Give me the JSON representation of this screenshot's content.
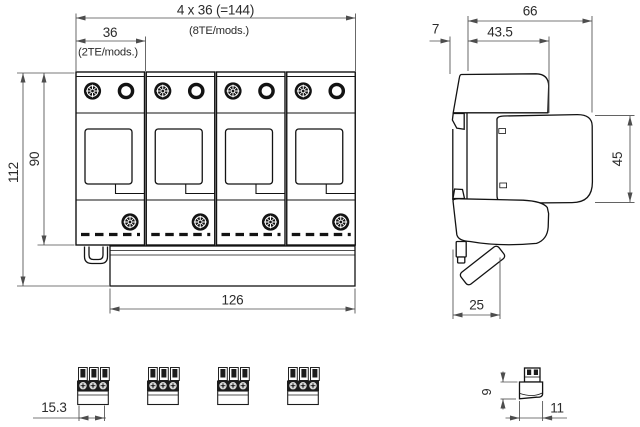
{
  "drawing": {
    "type": "technical-dimension-drawing",
    "units": "mm",
    "front_view": {
      "module_count": 4,
      "dims": {
        "total_width": "4 x 36 (=144)",
        "total_width_note": "(8TE/mods.)",
        "module_width": "36",
        "module_width_note": "(2TE/mods.)",
        "overall_height": "112",
        "body_height": "90",
        "rail_length": "126"
      }
    },
    "side_view": {
      "dims": {
        "total_depth": "66",
        "rear_offset": "7",
        "upper_depth": "43.5",
        "front_height": "45",
        "lower_depth": "25"
      }
    },
    "bottom_view": {
      "terminal_count": 4,
      "dims": {
        "terminal_width": "15.3"
      }
    },
    "terminal_side_view": {
      "dims": {
        "height": "9",
        "depth": "11"
      }
    },
    "colors": {
      "outline": "#131313",
      "dimension": "#4d4d4d",
      "background": "#ffffff"
    }
  }
}
